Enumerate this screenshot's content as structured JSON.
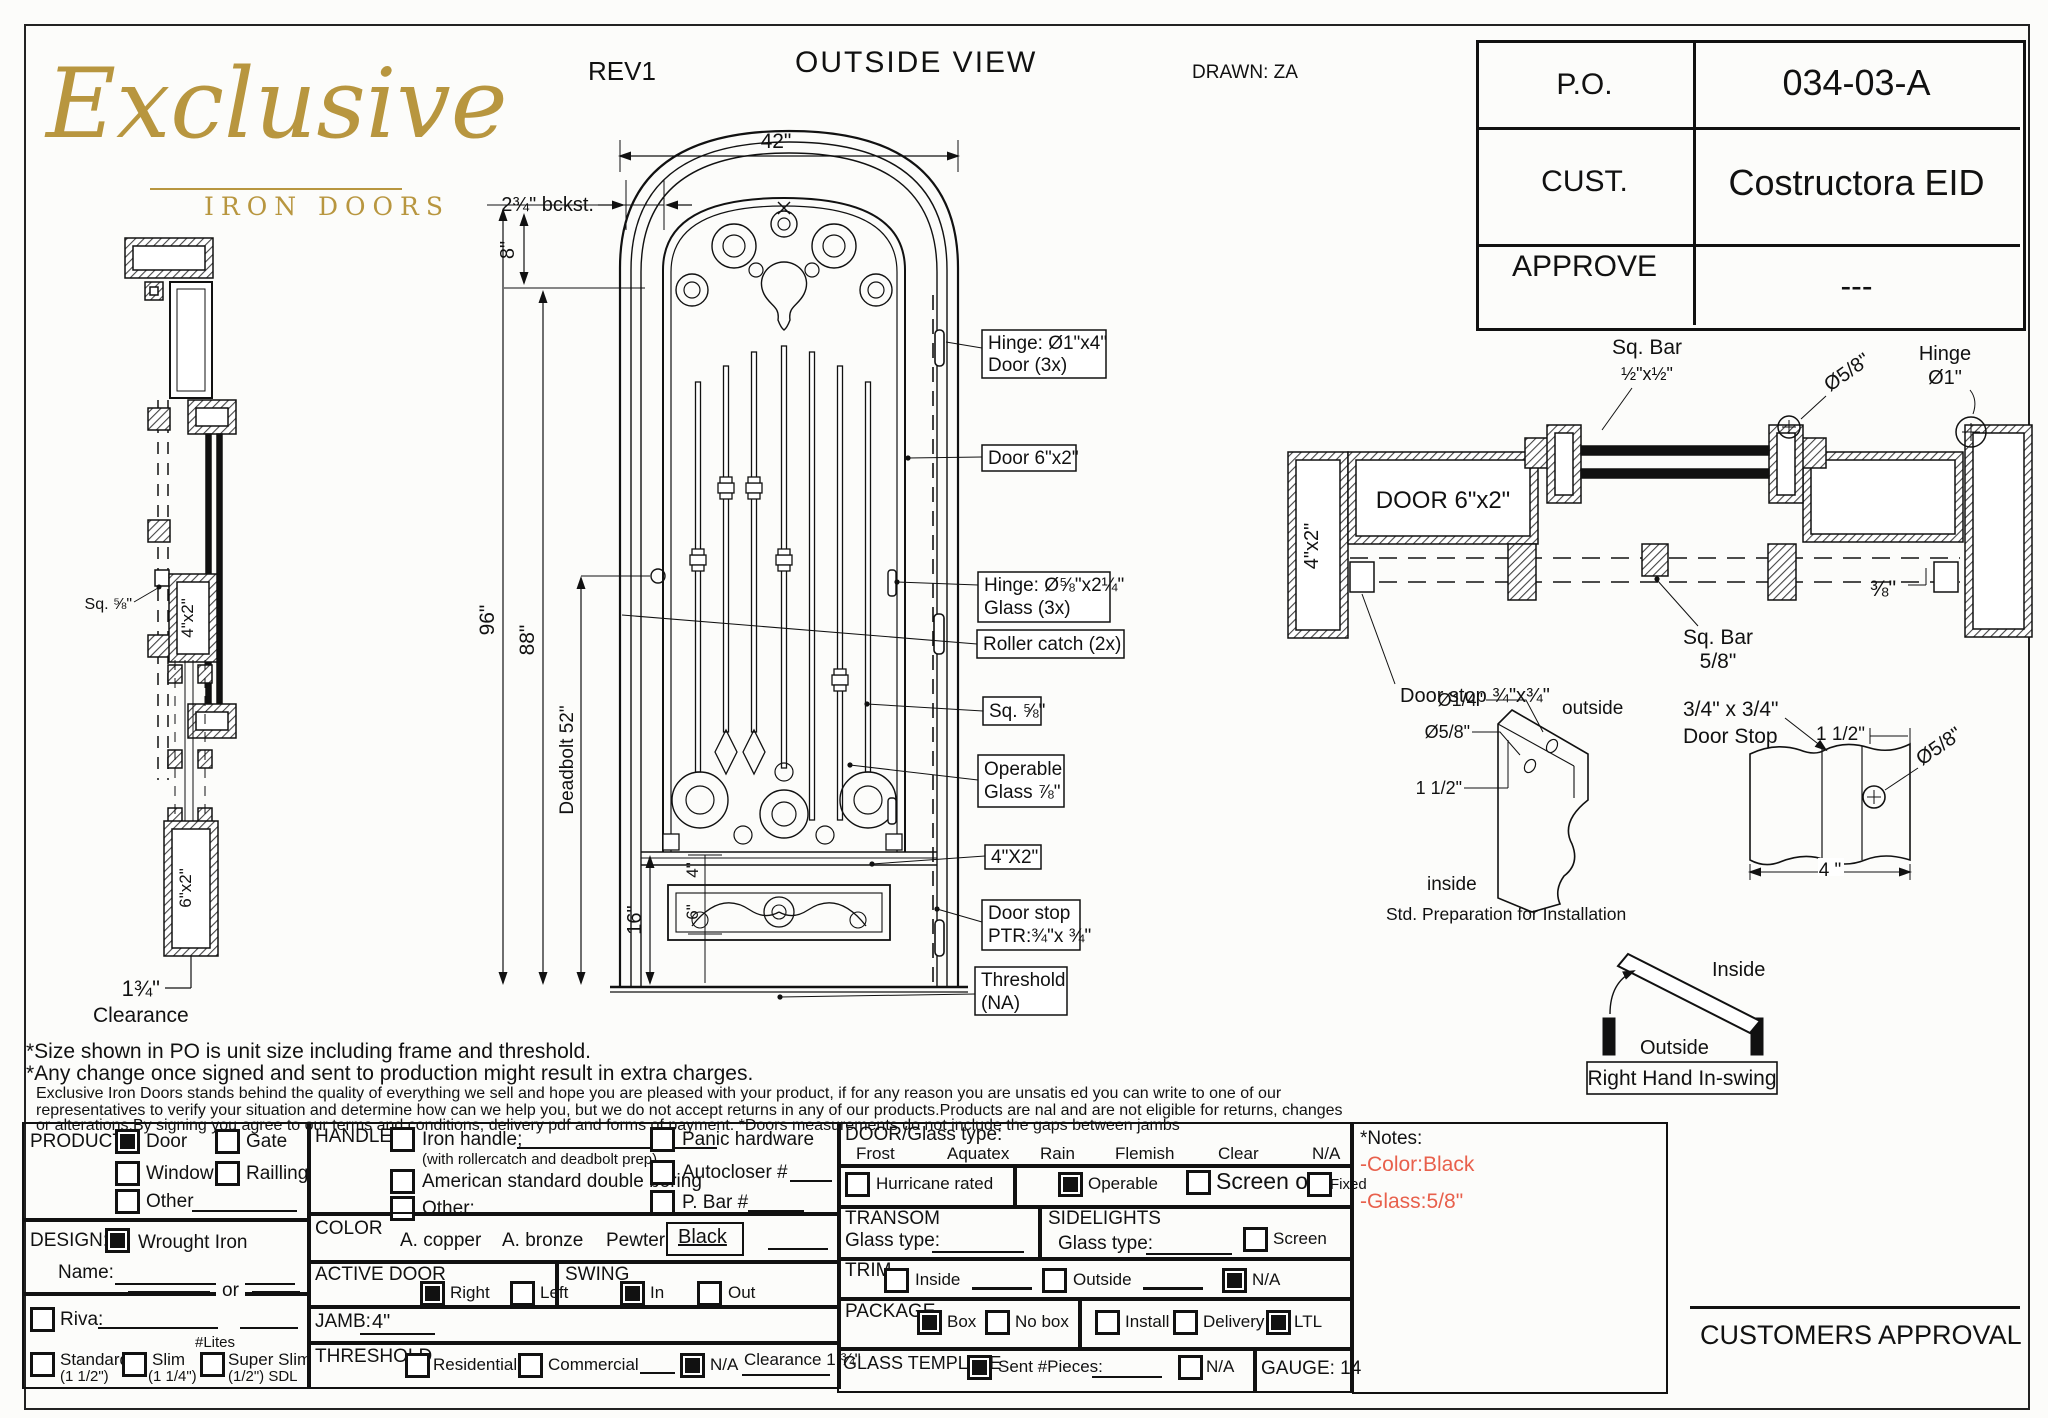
{
  "colors": {
    "gold": "#b8963f",
    "note_red": "#e8604c",
    "ink": "#111111"
  },
  "logo": {
    "script": "Exclusive",
    "sub": "IRON DOORS"
  },
  "header": {
    "rev": "REV1",
    "title": "OUTSIDE VIEW",
    "drawn": "DRAWN: ZA"
  },
  "info_table": {
    "po_label": "P.O.",
    "po_value": "034-03-A",
    "cust_label": "CUST.",
    "cust_value": "Costructora EID",
    "approve_label": "APPROVE",
    "approve_value": "---"
  },
  "front_view": {
    "dim_width": "42\"",
    "dim_backset": "2¾\" bckst.",
    "dim_top": "8\"",
    "dim_height": "96\"",
    "dim_leaf": "88\"",
    "dim_deadbolt": "Deadbolt 52\"",
    "dim_bottom": "16\"",
    "dim_kick_gap": "4\"",
    "dim_kick": "6\"",
    "callouts": {
      "hinge_door_1": "Hinge: Ø1\"x4\"",
      "hinge_door_2": "Door (3x)",
      "door": "Door 6\"x2\"",
      "hinge_glass_1": "Hinge: Ø⅝\"x2¼\"",
      "hinge_glass_2": "Glass (3x)",
      "roller": "Roller catch  (2x)",
      "sq": "Sq. ⅝\"",
      "operable_1": "Operable",
      "operable_2": "Glass ⅞\"",
      "rail": "4\"X2\"",
      "doorstop_1": "Door stop",
      "doorstop_2": "PTR:¾\"x ¾\"",
      "threshold_1": "Threshold",
      "threshold_2": "(NA)"
    }
  },
  "profile": {
    "sq": "Sq. ⅝\"",
    "jamb": "4\"x2\"",
    "door": "6\"x2\"",
    "clearance_value": "1¾\"",
    "clearance_label": "Clearance"
  },
  "section": {
    "sq_bar_top_1": "Sq. Bar",
    "sq_bar_top_2": "½\"x½\"",
    "dia_58": "Ø5/8\"",
    "hinge_1": "Hinge",
    "hinge_2": "Ø1\"",
    "door": "DOOR 6\"x2\"",
    "jamb": "4\"x2\"",
    "sq_bar_bot_1": "Sq. Bar",
    "sq_bar_bot_2": "5/8\"",
    "dim_38": "⅜\"",
    "doorstop": "Door stop ¾\"x¾\""
  },
  "prep_detail": {
    "dia_14": "Ø1/4\"",
    "dia_58": "Ø5/8\"",
    "dim_112": "1 1/2\"",
    "outside": "outside",
    "inside": "inside",
    "caption": "Std. Preparation for Installation"
  },
  "stop_detail": {
    "title_1": "3/4\" x 3/4\"",
    "title_2": "Door Stop",
    "dim_112": "1 1/2\"",
    "dia_58": "Ø5/8\"",
    "dim_4": "4 \""
  },
  "swing_diagram": {
    "inside": "Inside",
    "outside": "Outside",
    "caption": "Right Hand In-swing"
  },
  "disclaimer": {
    "line1": "*Size shown in PO is unit size including frame and threshold.",
    "line2": "*Any change once signed and sent to production might result in extra charges.",
    "line3": "Exclusive Iron Doors stands behind the quality of everything we sell and hope you are pleased with your product, if for any reason you are unsatis   ed you can write to one of our",
    "line4": "representatives to verify your situation and determine how can we help you, but we do not accept returns in any of our products.Products are    nal and are not eligible for returns, changes",
    "line5": "or alterations.By signing you agree to our terms and conditions, delivery pdf and forms of payment. *Doors measurements do not include the gaps between jambs"
  },
  "form": {
    "product": {
      "label": "PRODUCT:",
      "door": {
        "label": "Door",
        "checked": true
      },
      "gate": {
        "label": "Gate",
        "checked": false
      },
      "window": {
        "label": "Window",
        "checked": false
      },
      "railling": {
        "label": "Railling",
        "checked": false
      },
      "other": {
        "label": "Other",
        "checked": false
      }
    },
    "design": {
      "label": "DESIGN:",
      "wrought": {
        "label": "Wrought Iron",
        "checked": true
      },
      "name_label": "Name:",
      "or_label": "or",
      "riva": {
        "label": "Riva:",
        "checked": false
      },
      "lites": "#Lites",
      "standard": {
        "label": "Standard",
        "sub": "(1 1/2\")",
        "checked": false
      },
      "slim": {
        "label": "Slim",
        "sub": "(1 1/4\")",
        "checked": false
      },
      "super_slim": {
        "label": "Super Slim",
        "sub": "(1/2\") SDL",
        "checked": false
      }
    },
    "handle": {
      "label": "HANDLE",
      "iron": {
        "label": "Iron handle;",
        "checked": false
      },
      "iron_sub": "(with rollercatch and deadbolt prep)",
      "american": {
        "label": "American standard double boring",
        "checked": false
      },
      "other": {
        "label": "Other:",
        "checked": false
      },
      "panic": {
        "label": "Panic hardware",
        "checked": false
      },
      "autocloser": {
        "label": "Autocloser #",
        "checked": false
      },
      "pbar": {
        "label": "P. Bar #",
        "checked": false
      }
    },
    "color": {
      "label": "COLOR",
      "copper": "A. copper",
      "bronze": "A. bronze",
      "pewter": "Pewter",
      "black": "Black"
    },
    "active_door": {
      "label": "ACTIVE DOOR",
      "right": {
        "label": "Right",
        "checked": true
      },
      "left": {
        "label": "Left",
        "checked": false
      }
    },
    "swing": {
      "label": "SWING",
      "in": {
        "label": "In",
        "checked": true
      },
      "out": {
        "label": "Out",
        "checked": false
      }
    },
    "jamb": {
      "label": "JAMB:",
      "value": "4\""
    },
    "threshold": {
      "label": "THRESHOLD",
      "residential": {
        "label": "Residential",
        "checked": false
      },
      "commercial": {
        "label": "Commercial",
        "checked": false
      },
      "na": {
        "label": "N/A",
        "checked": true
      },
      "clearance": "Clearance 1 ¾\""
    },
    "glass": {
      "label": "DOOR/Glass type:",
      "frost": "Frost",
      "aquatex": "Aquatex",
      "rain": "Rain",
      "flemish": "Flemish",
      "clear": "Clear",
      "na": "N/A"
    },
    "hurricane": {
      "label": "Hurricane rated",
      "checked": false
    },
    "operable_row": {
      "operable": {
        "label": "Operable",
        "checked": true
      },
      "screen": {
        "label": "Screen or",
        "checked": false
      },
      "fixed": {
        "label": "Fixed",
        "checked": false
      }
    },
    "transom": {
      "label": "TRANSOM",
      "glass_label": "Glass type:"
    },
    "sidelights": {
      "label": "SIDELIGHTS",
      "glass_label": "Glass type:",
      "screen": {
        "label": "Screen",
        "checked": false
      }
    },
    "trim": {
      "label": "TRIM",
      "inside": {
        "label": "Inside",
        "checked": false
      },
      "outside": {
        "label": "Outside",
        "checked": false
      },
      "na": {
        "label": "N/A",
        "checked": true
      }
    },
    "package": {
      "label": "PACKAGE",
      "box": {
        "label": "Box",
        "checked": true
      },
      "nobox": {
        "label": "No box",
        "checked": false
      },
      "install": {
        "label": "Install",
        "checked": false
      },
      "delivery": {
        "label": "Delivery",
        "checked": false
      },
      "ltl": {
        "label": "LTL",
        "checked": true
      }
    },
    "glass_template": {
      "label": "GLASS TEMPLATE",
      "sent": {
        "label": "Sent #Pieces:",
        "checked": true
      },
      "na": {
        "label": "N/A",
        "checked": false
      }
    },
    "gauge": "GAUGE: 14",
    "notes": {
      "title": "*Notes:",
      "line1": "-Color:Black",
      "line2": "-Glass:5/8\""
    }
  },
  "approval": {
    "label": "CUSTOMERS APPROVAL"
  }
}
